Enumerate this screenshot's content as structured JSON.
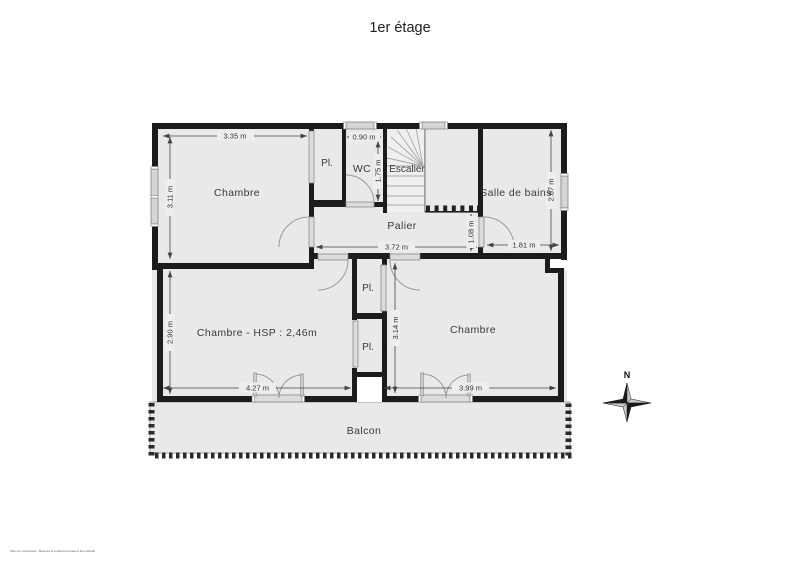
{
  "page": {
    "title": "1er étage",
    "disclaimer": "Plan non contractuel - Mesures et surfaces données à titre indicatif"
  },
  "compass": {
    "north": "N"
  },
  "rooms": {
    "chambre_top": "Chambre",
    "pl_top": "Pl.",
    "wc": "WC",
    "escalier": "Escalier",
    "salle_de_bains": "Salle de bains",
    "palier": "Palier",
    "chambre_left": "Chambre - HSP : 2,46m",
    "pl_upper": "Pl.",
    "pl_lower": "Pl.",
    "chambre_right": "Chambre",
    "balcon": "Balcon"
  },
  "dimensions": {
    "top_room_width": "3.35 m",
    "top_room_height": "3.11 m",
    "wc_width": "0.90 m",
    "wc_height": "1.75 m",
    "bathroom_height": "2.87 m",
    "bathroom_width": "1.81 m",
    "palier_width": "3.72 m",
    "palier_depth": "1.08 m",
    "left_room_height": "2.90 m",
    "left_room_width": "4.27 m",
    "right_room_height": "3.14 m",
    "right_room_width": "3.99 m"
  }
}
